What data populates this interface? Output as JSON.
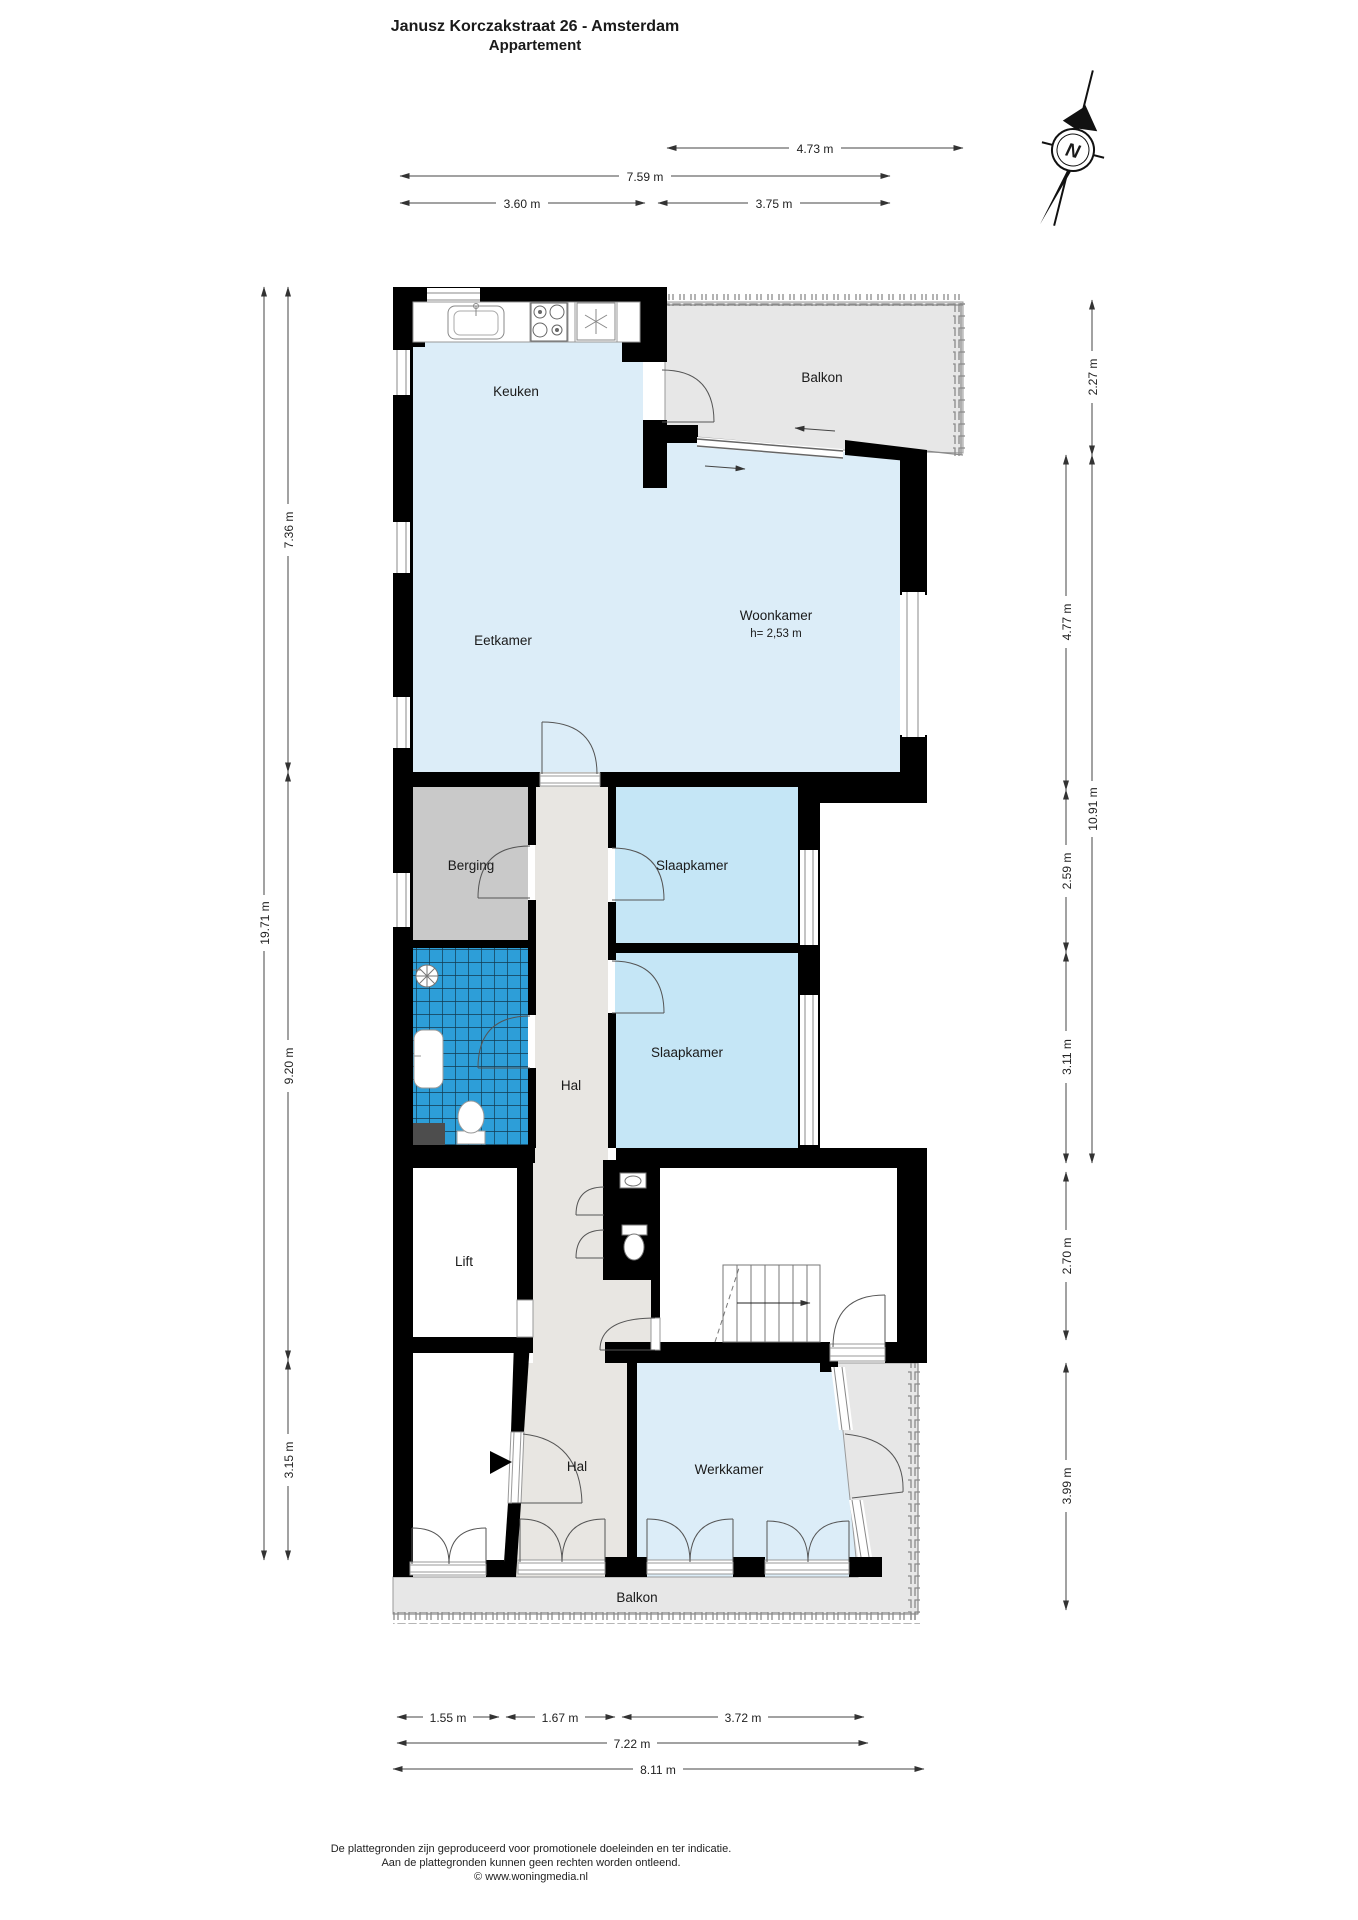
{
  "title": {
    "line1": "Janusz Korczakstraat 26 - Amsterdam",
    "line2": "Appartement"
  },
  "compass": {
    "label": "N"
  },
  "rooms": {
    "keuken": "Keuken",
    "balkon_boven": "Balkon",
    "eetkamer": "Eetkamer",
    "woonkamer": "Woonkamer",
    "woonkamer_hoogte": "h= 2,53 m",
    "berging": "Berging",
    "slaapkamer1": "Slaapkamer",
    "slaapkamer2": "Slaapkamer",
    "hal_boven": "Hal",
    "lift": "Lift",
    "hal_onder": "Hal",
    "werkkamer": "Werkkamer",
    "balkon_onder": "Balkon"
  },
  "dimensions": {
    "top": {
      "d1": "4.73 m",
      "d2": "7.59 m",
      "d3": "3.60 m",
      "d4": "3.75 m"
    },
    "left": {
      "total": "19.71 m",
      "d1": "7.36 m",
      "d2": "9.20 m",
      "d3": "3.15 m"
    },
    "right": {
      "d1": "2.27 m",
      "d2": "10.91 m",
      "d3": "4.77 m",
      "d4": "2.59 m",
      "d5": "3.11 m",
      "d6": "2.70 m",
      "d7": "3.99 m"
    },
    "bottom": {
      "d1": "1.55 m",
      "d2": "1.67 m",
      "d3": "3.72 m",
      "d4": "7.22 m",
      "d5": "8.11 m"
    }
  },
  "footer": {
    "line1": "De plattegronden zijn geproduceerd voor promotionele doeleinden en ter indicatie.",
    "line2": "Aan de plattegronden kunnen geen rechten worden ontleend.",
    "line3": "© www.woningmedia.nl"
  },
  "colors": {
    "wall": "#000000",
    "floor_living": "#dcedf8",
    "floor_bedroom": "#c5e6f6",
    "floor_bath": "#2d9ed8",
    "floor_storage": "#c9c9c9",
    "floor_hall": "#e8e6e2",
    "floor_balcony": "#e7e7e7",
    "floor_wc": "#a3a3a3",
    "mat": "#4d4d4d"
  }
}
